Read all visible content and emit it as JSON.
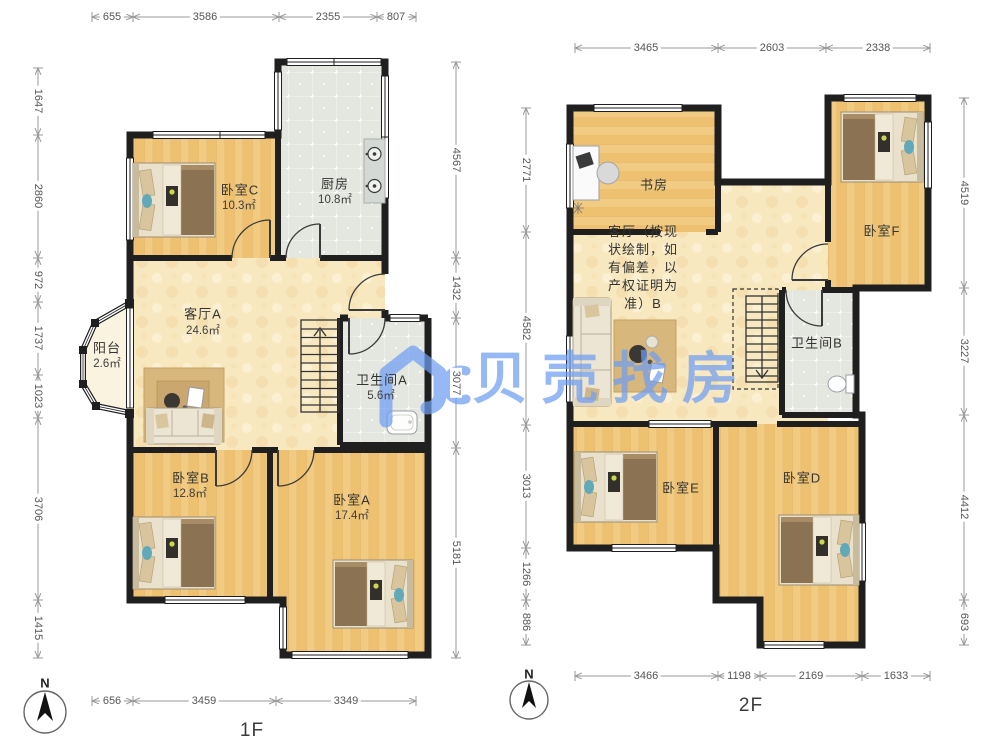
{
  "watermark": {
    "brand": "贝壳找房"
  },
  "colors": {
    "watermark_blue": "#6f9ef2",
    "wall": "#1f1f1f",
    "wood_floor": "#f2cb83",
    "living_floor": "#f8e8c0",
    "tile_floor": "#e4e6e0"
  },
  "floor1": {
    "label": "1F",
    "compass_label": "N",
    "dims": {
      "top": [
        "655",
        "3586",
        "2355",
        "807"
      ],
      "left": [
        "1647",
        "2860",
        "972",
        "1737",
        "1023",
        "3706",
        "1415"
      ],
      "right": [
        "4567",
        "1432",
        "3077",
        "5181"
      ],
      "bottom": [
        "656",
        "3459",
        "3349"
      ]
    },
    "rooms": {
      "bedroom_c": {
        "name": "卧室C",
        "area": "10.3㎡"
      },
      "kitchen": {
        "name": "厨房",
        "area": "10.8㎡"
      },
      "living_a": {
        "name": "客厅A",
        "area": "24.6㎡"
      },
      "balcony": {
        "name": "阳台",
        "area": "2.6㎡"
      },
      "bath_a": {
        "name": "卫生间A",
        "area": "5.6㎡"
      },
      "bedroom_b": {
        "name": "卧室B",
        "area": "12.8㎡"
      },
      "bedroom_a": {
        "name": "卧室A",
        "area": "17.4㎡"
      }
    }
  },
  "floor2": {
    "label": "2F",
    "compass_label": "N",
    "dims": {
      "top": [
        "3465",
        "2603",
        "2338"
      ],
      "left": [
        "2771",
        "4582",
        "3013",
        "1266",
        "886"
      ],
      "right": [
        "4519",
        "3227",
        "4412",
        "693"
      ],
      "bottom": [
        "3466",
        "1198",
        "2169",
        "1633"
      ]
    },
    "rooms": {
      "study": {
        "name": "书房"
      },
      "bedroom_f": {
        "name": "卧室F"
      },
      "living_b": {
        "name": "客厅（按现状绘制，如有偏差，以产权证明为准）B"
      },
      "bath_b": {
        "name": "卫生间B"
      },
      "bedroom_e": {
        "name": "卧室E"
      },
      "bedroom_d": {
        "name": "卧室D"
      }
    }
  }
}
